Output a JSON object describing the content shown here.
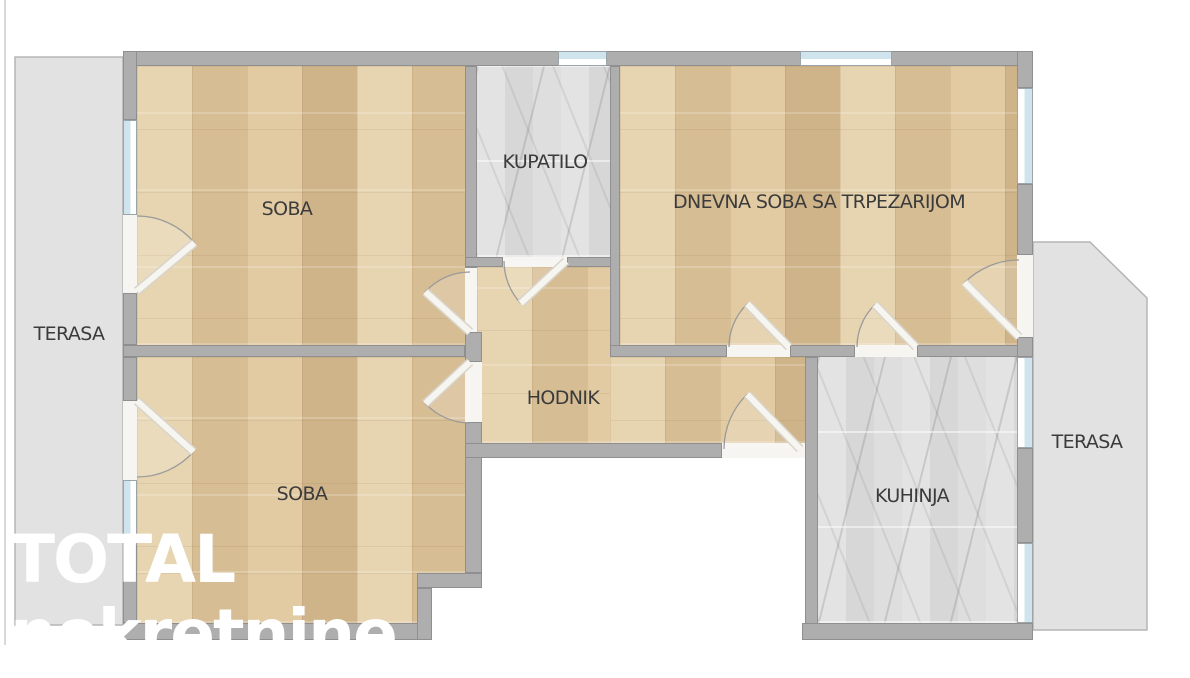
{
  "watermark": {
    "line1": "TOTAL",
    "line2": "nekretnine"
  },
  "colors": {
    "wall_fill": "#aeaeae",
    "wall_border": "#8f8f8f",
    "terrace_fill": "#e2e2e2",
    "terrace_border": "#b5b5b5",
    "window_glass": "#cfe4ec",
    "door_opening": "#f7f5f1",
    "door_leaf": "#f7f5f0",
    "door_leaf_edge": "#d8d4cc",
    "door_arc": "#9a9a9a",
    "label_text": "#3b3b3b",
    "wood_floor": "#dcc49d",
    "tile_floor": "#dddddd"
  },
  "plan": {
    "frame_line": {
      "x": 4,
      "y": 0,
      "w": 2,
      "h": 645
    },
    "rooms": [
      {
        "id": "soba-1",
        "label": "SOBA",
        "floor": "wood",
        "label_x": 287,
        "label_y": 209,
        "rects": [
          [
            137,
            66,
            328,
            279
          ]
        ]
      },
      {
        "id": "kupatilo",
        "label": "KUPATILO",
        "floor": "tile",
        "label_x": 545,
        "label_y": 162,
        "rects": [
          [
            477,
            66,
            133,
            191
          ]
        ]
      },
      {
        "id": "dnevna-soba",
        "label": "DNEVNA SOBA SA TRPEZARIJOM",
        "floor": "wood",
        "label_x": 819,
        "label_y": 202,
        "rects": [
          [
            620,
            66,
            397,
            279
          ]
        ]
      },
      {
        "id": "hodnik",
        "label": "HODNIK",
        "floor": "wood",
        "label_x": 563,
        "label_y": 398,
        "rects": [
          [
            477,
            267,
            133,
            176
          ],
          [
            610,
            357,
            195,
            86
          ]
        ]
      },
      {
        "id": "soba-2",
        "label": "SOBA",
        "floor": "wood",
        "label_x": 302,
        "label_y": 494,
        "rects": [
          [
            137,
            357,
            328,
            216
          ],
          [
            137,
            573,
            280,
            50
          ]
        ]
      },
      {
        "id": "kuhinja",
        "label": "KUHINJA",
        "floor": "tile",
        "label_x": 912,
        "label_y": 496,
        "rects": [
          [
            818,
            357,
            199,
            266
          ]
        ]
      }
    ],
    "terraces": [
      {
        "id": "left",
        "label": "TERASA",
        "label_x": 69,
        "label_y": 334,
        "points": [
          [
            15,
            57
          ],
          [
            123,
            57
          ],
          [
            123,
            625
          ],
          [
            15,
            625
          ]
        ]
      },
      {
        "id": "right",
        "label": "TERASA",
        "label_x": 1087,
        "label_y": 442,
        "points": [
          [
            1033,
            242
          ],
          [
            1090,
            242
          ],
          [
            1147,
            298
          ],
          [
            1147,
            630
          ],
          [
            1033,
            630
          ]
        ]
      }
    ],
    "walls": [
      [
        123,
        51,
        910,
        15
      ],
      [
        123,
        51,
        14,
        69
      ],
      [
        123,
        293,
        14,
        52
      ],
      [
        123,
        345,
        342,
        12
      ],
      [
        123,
        357,
        14,
        44
      ],
      [
        123,
        545,
        14,
        78
      ],
      [
        123,
        623,
        309,
        17
      ],
      [
        417,
        573,
        65,
        15
      ],
      [
        417,
        588,
        15,
        52
      ],
      [
        465,
        66,
        12,
        202
      ],
      [
        465,
        332,
        17,
        30
      ],
      [
        465,
        422,
        17,
        151
      ],
      [
        465,
        257,
        38,
        10
      ],
      [
        567,
        257,
        53,
        10
      ],
      [
        610,
        66,
        10,
        291
      ],
      [
        610,
        345,
        117,
        12
      ],
      [
        790,
        345,
        65,
        12
      ],
      [
        917,
        345,
        116,
        12
      ],
      [
        805,
        357,
        13,
        283
      ],
      [
        465,
        443,
        257,
        15
      ],
      [
        1017,
        51,
        16,
        37
      ],
      [
        1017,
        184,
        16,
        71
      ],
      [
        1017,
        337,
        16,
        20
      ],
      [
        1017,
        448,
        16,
        95
      ],
      [
        802,
        623,
        231,
        17
      ]
    ],
    "openings": [
      [
        123,
        215,
        14,
        78
      ],
      [
        123,
        401,
        14,
        79
      ],
      [
        465,
        268,
        12,
        64
      ],
      [
        465,
        362,
        17,
        60
      ],
      [
        503,
        257,
        64,
        10
      ],
      [
        727,
        345,
        63,
        12
      ],
      [
        855,
        345,
        62,
        12
      ],
      [
        1017,
        255,
        16,
        82
      ],
      [
        722,
        443,
        83,
        15
      ]
    ],
    "windows": [
      {
        "rect": [
          123,
          120,
          14,
          95
        ],
        "side": "left"
      },
      {
        "rect": [
          123,
          480,
          14,
          65
        ],
        "side": "left"
      },
      {
        "rect": [
          558,
          51,
          49,
          15
        ],
        "side": "top"
      },
      {
        "rect": [
          800,
          51,
          92,
          15
        ],
        "side": "top"
      },
      {
        "rect": [
          1017,
          88,
          16,
          96
        ],
        "side": "right"
      },
      {
        "rect": [
          1017,
          357,
          16,
          91
        ],
        "side": "right"
      },
      {
        "rect": [
          1017,
          543,
          16,
          80
        ],
        "side": "right"
      }
    ],
    "doors": [
      {
        "id": "soba1-terasa",
        "hinge": [
          137,
          291
        ],
        "r": 75,
        "from": -90,
        "to": -40
      },
      {
        "id": "soba1-hodnik",
        "hinge": [
          470,
          332
        ],
        "r": 60,
        "from": -90,
        "to": -138
      },
      {
        "id": "soba2-terasa",
        "hinge": [
          137,
          401
        ],
        "r": 76,
        "from": 90,
        "to": 42
      },
      {
        "id": "soba2-hodnik",
        "hinge": [
          470,
          362
        ],
        "r": 61,
        "from": 90,
        "to": 137
      },
      {
        "id": "kupatilo",
        "hinge": [
          566,
          261
        ],
        "r": 62,
        "from": 180,
        "to": 137
      },
      {
        "id": "dnevna-hodnik",
        "hinge": [
          789,
          347
        ],
        "r": 60,
        "from": 180,
        "to": 226
      },
      {
        "id": "dnevna-kuhinja",
        "hinge": [
          916,
          347
        ],
        "r": 59,
        "from": 180,
        "to": 226
      },
      {
        "id": "dnevna-terasa",
        "hinge": [
          1019,
          337
        ],
        "r": 77,
        "from": -90,
        "to": -135
      },
      {
        "id": "ulaz",
        "hinge": [
          800,
          449
        ],
        "r": 76,
        "from": 180,
        "to": 226
      }
    ]
  }
}
